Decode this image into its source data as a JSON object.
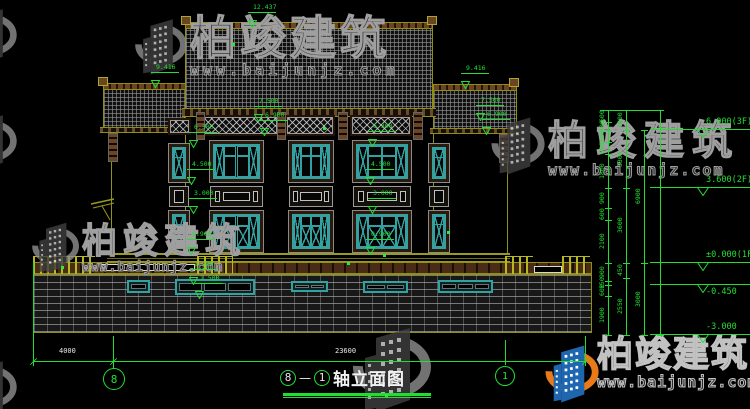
{
  "title": {
    "axis_a": "8",
    "dash": "—",
    "axis_b": "1",
    "label": "轴立面图"
  },
  "watermark": {
    "brand": "柏竣建筑",
    "url": "www.baijunjz.com"
  },
  "colors": {
    "cad_green": "#21df32",
    "olive": "#92921a",
    "teal": "#35a0a0",
    "window_brown": "#5a3517",
    "ridge_brown": "#6b4423",
    "white": "#e9e9e9",
    "watermark_grey": "#9f9f9f",
    "logo_blue": "#1f66b0",
    "logo_orange": "#e87a1a"
  },
  "elevation_flags": [
    {
      "y": 130,
      "label": "6.900(3F)",
      "pos": "above"
    },
    {
      "y": 188,
      "label": "3.600(2F)",
      "pos": "above"
    },
    {
      "y": 263,
      "label": "±0.000(1F)",
      "pos": "above"
    },
    {
      "y": 285,
      "label": "-0.450",
      "pos": "below"
    },
    {
      "y": 335,
      "label": "-3.000",
      "pos": "above"
    }
  ],
  "markers": [
    {
      "x": 252,
      "y": 20,
      "label": "12.437"
    },
    {
      "x": 155,
      "y": 80,
      "label": "9.416"
    },
    {
      "x": 465,
      "y": 81,
      "label": "9.416"
    },
    {
      "x": 258,
      "y": 114,
      "label": "7.500"
    },
    {
      "x": 264,
      "y": 128,
      "label": "6.900"
    },
    {
      "x": 480,
      "y": 113,
      "label": "7.500"
    },
    {
      "x": 486,
      "y": 127,
      "label": "6.900"
    },
    {
      "x": 193,
      "y": 140,
      "label": "6.300"
    },
    {
      "x": 191,
      "y": 177,
      "label": "4.500"
    },
    {
      "x": 193,
      "y": 206,
      "label": "3.000"
    },
    {
      "x": 191,
      "y": 247,
      "label": "0.900"
    },
    {
      "x": 372,
      "y": 139,
      "label": "6.300"
    },
    {
      "x": 370,
      "y": 177,
      "label": "4.500"
    },
    {
      "x": 372,
      "y": 206,
      "label": "3.000"
    },
    {
      "x": 370,
      "y": 247,
      "label": "0.900"
    },
    {
      "x": 193,
      "y": 277,
      "label": "2.200"
    },
    {
      "x": 199,
      "y": 291,
      "label": "1.500"
    }
  ],
  "vdim_cols": [
    {
      "x": 608,
      "segs": [
        [
          110,
          122,
          "600"
        ],
        [
          122,
          130,
          "400"
        ],
        [
          130,
          142,
          "600"
        ],
        [
          142,
          154,
          "600"
        ],
        [
          154,
          188,
          "1800"
        ],
        [
          188,
          208,
          "900"
        ],
        [
          208,
          220,
          "600"
        ],
        [
          220,
          263,
          "2100"
        ],
        [
          263,
          281,
          "900"
        ],
        [
          281,
          285,
          "150"
        ],
        [
          285,
          296,
          "600"
        ],
        [
          296,
          335,
          "1900"
        ]
      ]
    },
    {
      "x": 626,
      "segs": [
        [
          110,
          130,
          "1000"
        ],
        [
          130,
          188,
          "3300"
        ],
        [
          188,
          263,
          "3600"
        ],
        [
          263,
          278,
          "450"
        ],
        [
          278,
          335,
          "2550"
        ]
      ]
    },
    {
      "x": 644,
      "segs": [
        [
          130,
          263,
          "6900"
        ],
        [
          263,
          335,
          "3000"
        ]
      ]
    },
    {
      "x": 660,
      "segs": [
        [
          110,
          335,
          ""
        ]
      ]
    }
  ],
  "bottom_dims": [
    {
      "x1": 33,
      "x2": 113,
      "label": "4000"
    },
    {
      "x1": 113,
      "x2": 585,
      "label": "23600"
    }
  ],
  "axis_bubbles": [
    {
      "x": 114,
      "y": 379,
      "r": 11,
      "label": "8"
    },
    {
      "x": 505,
      "y": 376,
      "r": 10,
      "label": "1"
    }
  ],
  "dots": [
    [
      232,
      43
    ],
    [
      323,
      127
    ],
    [
      383,
      254
    ],
    [
      61,
      266
    ],
    [
      347,
      262
    ],
    [
      385,
      394
    ],
    [
      447,
      231
    ]
  ],
  "geometry": {
    "roofs": [
      {
        "x": 185,
        "y": 22,
        "w": 248,
        "h": 90,
        "name": "roof-main"
      },
      {
        "x": 103,
        "y": 83,
        "w": 83,
        "h": 48,
        "name": "roof-left"
      },
      {
        "x": 433,
        "y": 84,
        "w": 84,
        "h": 48,
        "name": "roof-right"
      }
    ],
    "caps": [
      [
        181,
        16,
        10,
        9
      ],
      [
        427,
        16,
        10,
        9
      ],
      [
        98,
        77,
        10,
        9
      ],
      [
        509,
        78,
        10,
        9
      ]
    ],
    "fascias": [
      [
        182,
        108,
        254,
        9
      ],
      [
        100,
        127,
        88,
        6
      ],
      [
        430,
        128,
        88,
        6
      ]
    ],
    "lattice": [
      [
        170,
        120,
        19,
        13
      ],
      [
        203,
        117,
        74,
        17
      ],
      [
        287,
        117,
        46,
        17
      ],
      [
        352,
        117,
        58,
        17
      ]
    ],
    "brackets": [
      [
        196,
        112,
        9,
        28
      ],
      [
        277,
        112,
        9,
        28
      ],
      [
        338,
        112,
        10,
        28
      ],
      [
        413,
        112,
        10,
        28
      ],
      [
        108,
        133,
        10,
        29
      ],
      [
        499,
        134,
        10,
        29
      ]
    ],
    "bays": [
      {
        "x": 168,
        "w": 22,
        "type": "narrow"
      },
      {
        "x": 209,
        "w": 55,
        "type": "wide"
      },
      {
        "x": 288,
        "w": 46,
        "type": "wide"
      },
      {
        "x": 352,
        "w": 60,
        "type": "wide"
      },
      {
        "x": 428,
        "w": 22,
        "type": "narrow"
      }
    ],
    "wall_lines": [
      [
        111,
        131,
        262
      ],
      [
        507,
        132,
        262
      ],
      [
        185,
        117,
        253
      ],
      [
        433,
        117,
        253
      ]
    ],
    "string_course": [
      107,
      253,
      403,
      9
    ],
    "fence": {
      "x": 33,
      "y": 262,
      "w": 559,
      "h": 71
    },
    "balustrades": [
      {
        "x": 33,
        "y": 256,
        "w": 62,
        "type": "posts"
      },
      {
        "x": 100,
        "y": 264,
        "w": 95,
        "type": "rail"
      },
      {
        "x": 197,
        "y": 256,
        "w": 36,
        "type": "posts"
      },
      {
        "x": 505,
        "y": 256,
        "w": 28,
        "type": "posts"
      },
      {
        "x": 534,
        "y": 266,
        "w": 28,
        "type": "rail"
      },
      {
        "x": 562,
        "y": 256,
        "w": 28,
        "type": "posts"
      }
    ],
    "vents": [
      [
        127,
        280,
        23,
        13,
        1
      ],
      [
        175,
        279,
        80,
        16,
        3
      ],
      [
        291,
        281,
        37,
        11,
        2
      ],
      [
        363,
        281,
        45,
        12,
        2
      ],
      [
        438,
        280,
        55,
        13,
        3
      ]
    ],
    "ext_lines": [
      [
        33,
        262,
        366
      ],
      [
        113,
        336,
        369
      ],
      [
        585,
        336,
        366
      ],
      [
        505,
        340,
        365
      ]
    ],
    "dim_line": {
      "y": 361,
      "x1": 33,
      "x2": 585
    }
  }
}
